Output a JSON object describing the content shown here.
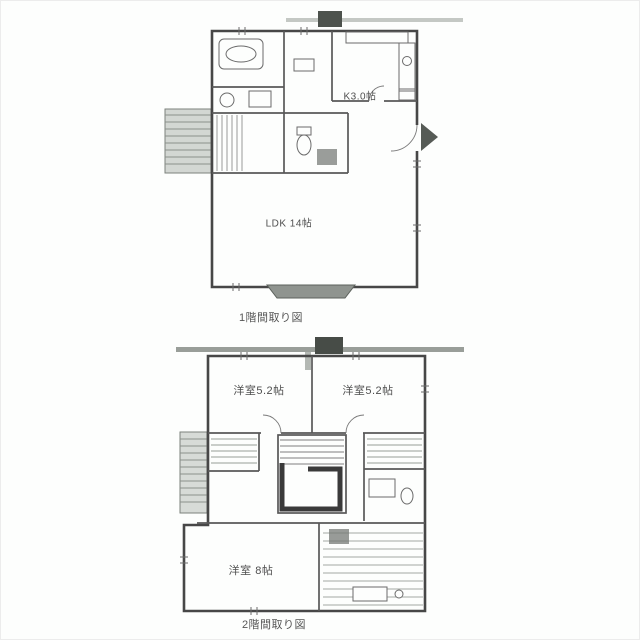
{
  "image": {
    "type": "scanned floor plan, two stacked plans (1st and 2nd floor)",
    "background": "#fdfefd"
  },
  "colors": {
    "exterior_wall": "#474747",
    "interior_wall": "#585858",
    "hatch": "#949994",
    "porch_fill": "#8f948f",
    "balcony_fill": "#d7dbd7",
    "scan_band": "#8e938e",
    "text": "#4f4f4f"
  },
  "floor1": {
    "caption": "1階間取り図",
    "labels": {
      "kitchen": "K3.0帖",
      "ldk": "LDK 14帖"
    }
  },
  "floor2": {
    "caption": "2階間取り図",
    "labels": {
      "bedroom_left": "洋室5.2帖",
      "bedroom_right": "洋室5.2帖",
      "bedroom_large": "洋室 8帖"
    }
  }
}
